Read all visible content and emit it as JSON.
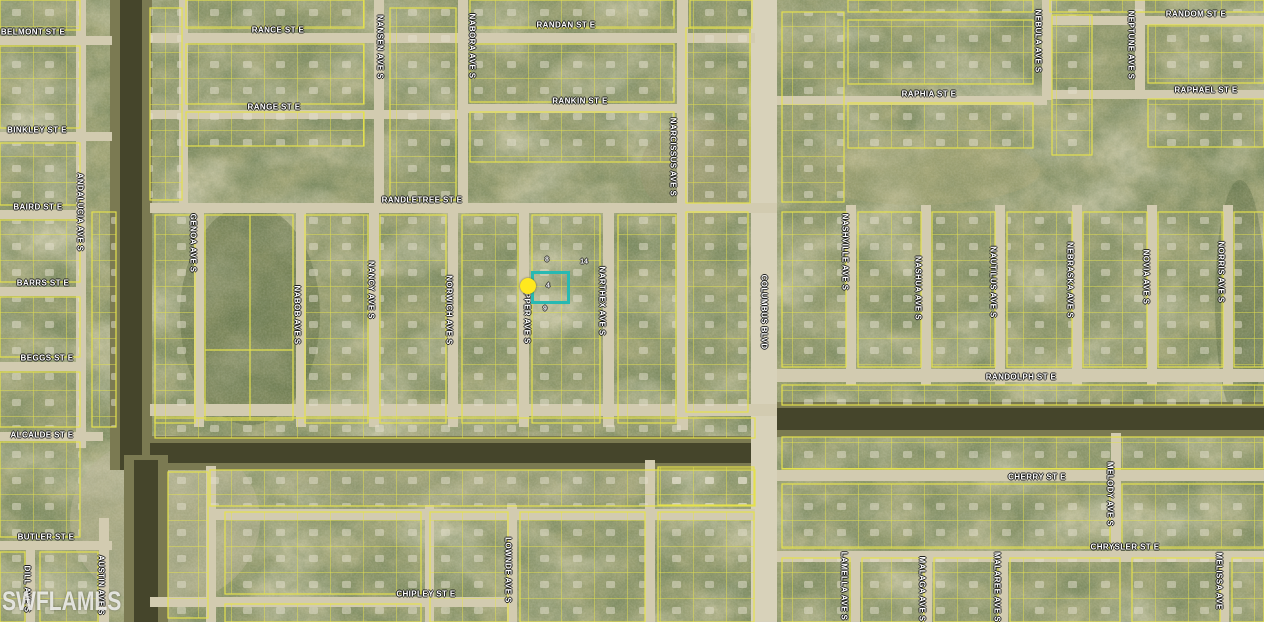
{
  "map": {
    "description": "Aerial parcel map with subject lot highlighted",
    "watermark": "SWFLAMLS",
    "colors": {
      "highlight_box": "#28b9b2",
      "marker": "#ffe81e",
      "parcel_lines": "#e4e14c",
      "road": "#d2cbb0",
      "canal": "#45452b",
      "terrain_base": "#a2a577",
      "label_text": "#ffffff"
    },
    "subject": {
      "parcel_number": "4",
      "highlight_box": {
        "x": 531,
        "y": 271,
        "w": 33,
        "h": 27
      },
      "marker": {
        "x": 520,
        "y": 278,
        "d": 16
      }
    },
    "parcel_numbers_visible": [
      {
        "value": "8",
        "x": 547,
        "y": 260
      },
      {
        "value": "14",
        "x": 584,
        "y": 262
      },
      {
        "value": "4",
        "x": 548,
        "y": 286
      },
      {
        "value": "9",
        "x": 545,
        "y": 309
      }
    ],
    "streets": {
      "horizontal": [
        {
          "label": "BELMONT ST E",
          "x": 33,
          "y": 32
        },
        {
          "label": "RANCE ST E",
          "x": 278,
          "y": 30
        },
        {
          "label": "RANDAN ST E",
          "x": 566,
          "y": 25
        },
        {
          "label": "RANDOM ST E",
          "x": 1196,
          "y": 14
        },
        {
          "label": "RANGE ST E",
          "x": 274,
          "y": 107
        },
        {
          "label": "RANKIN ST E",
          "x": 580,
          "y": 101
        },
        {
          "label": "RAPHIA ST E",
          "x": 929,
          "y": 94
        },
        {
          "label": "RAPHAEL ST E",
          "x": 1206,
          "y": 90
        },
        {
          "label": "BINKLEY ST E",
          "x": 37,
          "y": 130
        },
        {
          "label": "BAIRD ST E",
          "x": 38,
          "y": 207
        },
        {
          "label": "RANDLETREE ST E",
          "x": 422,
          "y": 200
        },
        {
          "label": "BARRS ST E",
          "x": 43,
          "y": 283
        },
        {
          "label": "BEGGS ST E",
          "x": 47,
          "y": 358
        },
        {
          "label": "RANDOLPH ST E",
          "x": 1021,
          "y": 377
        },
        {
          "label": "ALCALDE ST E",
          "x": 42,
          "y": 435
        },
        {
          "label": "BUTLER ST E",
          "x": 46,
          "y": 537
        },
        {
          "label": "CHERRY ST E",
          "x": 1037,
          "y": 477
        },
        {
          "label": "CHRYSLER ST E",
          "x": 1125,
          "y": 547
        },
        {
          "label": "CHIPLEY ST E",
          "x": 426,
          "y": 594
        }
      ],
      "vertical": [
        {
          "label": "ANDALUCIA AVE S",
          "x": 80,
          "y": 212
        },
        {
          "label": "NANSEN AVE S",
          "x": 380,
          "y": 47
        },
        {
          "label": "NABORA AVE S",
          "x": 472,
          "y": 46
        },
        {
          "label": "NEBULA AVE S",
          "x": 1038,
          "y": 41
        },
        {
          "label": "NEPTUNE AVE S",
          "x": 1131,
          "y": 45
        },
        {
          "label": "NARCISSUS AVE S",
          "x": 673,
          "y": 157
        },
        {
          "label": "GENOA AVE S",
          "x": 193,
          "y": 243
        },
        {
          "label": "NABOB AVE S",
          "x": 297,
          "y": 315
        },
        {
          "label": "NANCY AVE S",
          "x": 371,
          "y": 290
        },
        {
          "label": "NORWICH AVE S",
          "x": 449,
          "y": 310
        },
        {
          "label": "NAPPER AVE S",
          "x": 527,
          "y": 312
        },
        {
          "label": "NARTHEX AVE S",
          "x": 602,
          "y": 301
        },
        {
          "label": "COLUMBUS BLVD",
          "x": 764,
          "y": 312
        },
        {
          "label": "NASHVILLE AVE S",
          "x": 845,
          "y": 252
        },
        {
          "label": "NASHUA AVE S",
          "x": 918,
          "y": 288
        },
        {
          "label": "NAUTILUS AVE S",
          "x": 993,
          "y": 282
        },
        {
          "label": "NEBRASKA AVE S",
          "x": 1070,
          "y": 280
        },
        {
          "label": "NOVIA AVE S",
          "x": 1146,
          "y": 277
        },
        {
          "label": "NORRIS AVE S",
          "x": 1221,
          "y": 272
        },
        {
          "label": "AUSTIN AVE S",
          "x": 101,
          "y": 585
        },
        {
          "label": "DILL AVE S",
          "x": 27,
          "y": 589
        },
        {
          "label": "LOWNDE AVE S",
          "x": 508,
          "y": 570
        },
        {
          "label": "MELODY AVE S",
          "x": 1110,
          "y": 494
        },
        {
          "label": "LAMELLA AVE S",
          "x": 844,
          "y": 586
        },
        {
          "label": "MALAGA AVE S",
          "x": 922,
          "y": 589
        },
        {
          "label": "MALAREE AVE S",
          "x": 997,
          "y": 587
        },
        {
          "label": "MELISSA AVE",
          "x": 1219,
          "y": 581
        }
      ]
    }
  }
}
